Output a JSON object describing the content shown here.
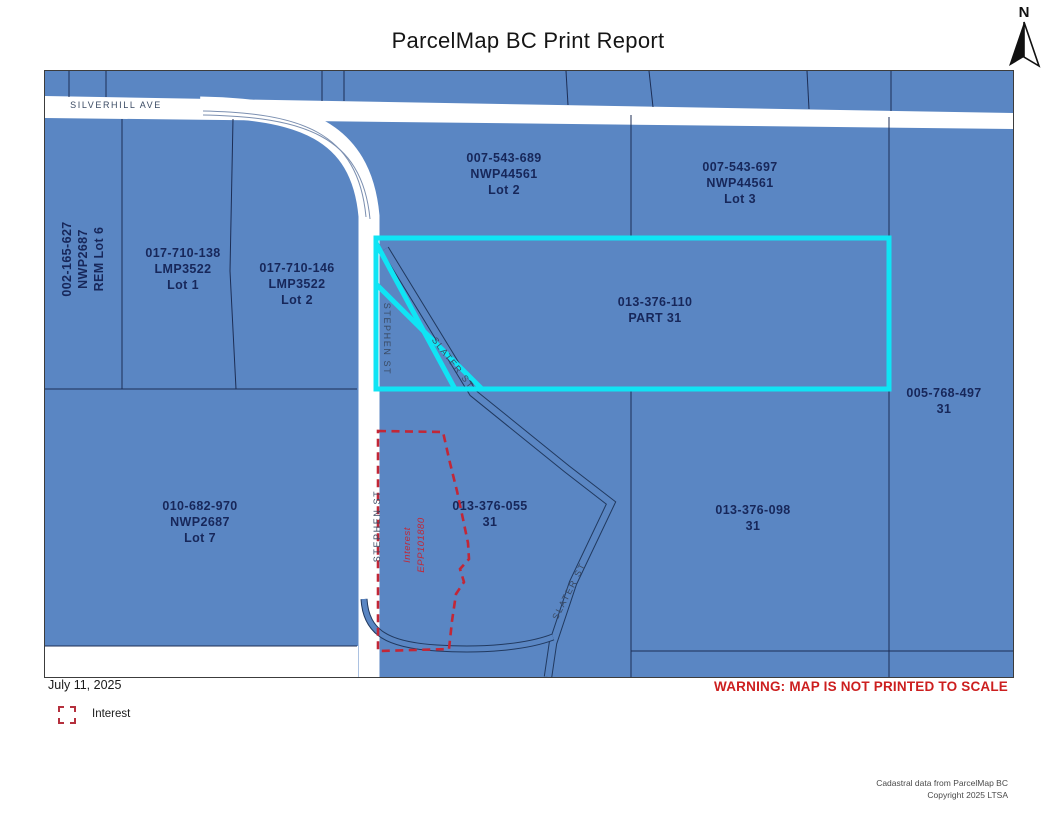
{
  "title": "ParcelMap BC Print Report",
  "north": {
    "label": "N"
  },
  "map": {
    "streets": {
      "silverhill": "SILVERHILL AVE",
      "stephen": "STEPHEN ST",
      "slater": "SLATER ST"
    },
    "parcels": [
      {
        "pid": "002-165-627",
        "plan": "NWP2687",
        "lot": "REM Lot 6"
      },
      {
        "pid": "017-710-138",
        "plan": "LMP3522",
        "lot": "Lot 1"
      },
      {
        "pid": "017-710-146",
        "plan": "LMP3522",
        "lot": "Lot 2"
      },
      {
        "pid": "007-543-689",
        "plan": "NWP44561",
        "lot": "Lot 2"
      },
      {
        "pid": "007-543-697",
        "plan": "NWP44561",
        "lot": "Lot 3"
      },
      {
        "pid": "013-376-110",
        "lot": "PART 31"
      },
      {
        "pid": "005-768-497",
        "lot": "31"
      },
      {
        "pid": "010-682-970",
        "plan": "NWP2687",
        "lot": "Lot 7"
      },
      {
        "pid": "013-376-055",
        "lot": "31"
      },
      {
        "pid": "013-376-098",
        "lot": "31"
      }
    ],
    "interest_annotation": {
      "line1": "Interest",
      "line2": "EPP101880"
    }
  },
  "footer": {
    "date": "July 11, 2025",
    "legend": {
      "label": "Interest"
    },
    "warning": "WARNING: MAP IS NOT PRINTED TO SCALE",
    "credits": {
      "line1": "Cadastral data from ParcelMap BC",
      "line2": "Copyright 2025 LTSA"
    }
  },
  "colors": {
    "parcel_fill": "#5a86c3",
    "boundary_line": "#1c2d54",
    "highlight_outline": "#10e4f4",
    "interest_outline": "#c22737",
    "warning_text": "#cc1f1f"
  }
}
